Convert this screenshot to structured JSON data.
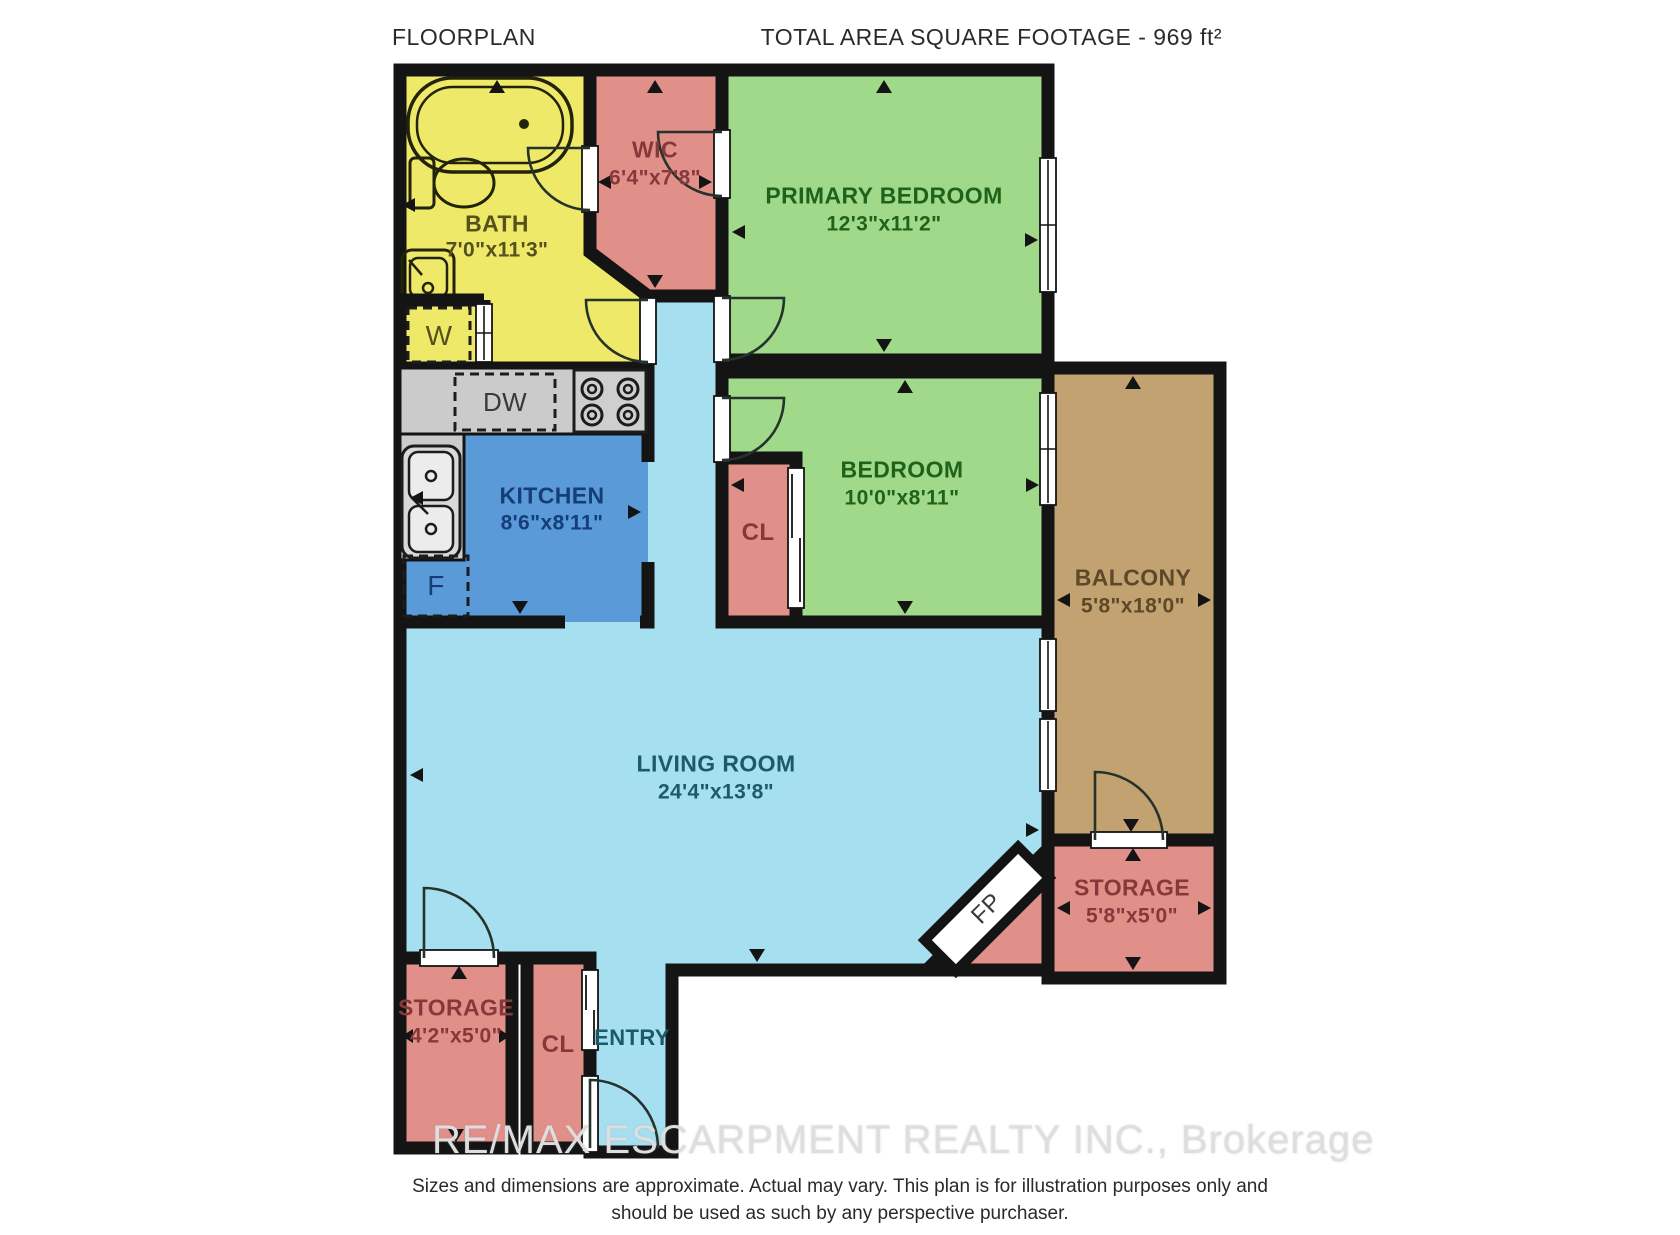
{
  "header": {
    "left": "FLOORPLAN",
    "right": "TOTAL AREA SQUARE FOOTAGE - 969 ft²"
  },
  "colors": {
    "bath": "#efe969",
    "closet": "#e18f89",
    "bedroom": "#a0d98a",
    "kitchen_floor": "#5a9ad8",
    "living": "#a6dff0",
    "balcony": "#c2a270",
    "counter": "#cbcbcb",
    "wall": "#141414"
  },
  "rooms": {
    "bath": {
      "name": "BATH",
      "dims": "7'0\"x11'3\""
    },
    "wic": {
      "name": "WIC",
      "dims": "6'4\"x7'8\""
    },
    "primary_bedroom": {
      "name": "PRIMARY BEDROOM",
      "dims": "12'3\"x11'2\""
    },
    "kitchen": {
      "name": "KITCHEN",
      "dims": "8'6\"x8'11\""
    },
    "bedroom": {
      "name": "BEDROOM",
      "dims": "10'0\"x8'11\""
    },
    "closet_hall": {
      "name": "CL"
    },
    "balcony": {
      "name": "BALCONY",
      "dims": "5'8\"x18'0\""
    },
    "living_room": {
      "name": "LIVING ROOM",
      "dims": "24'4\"x13'8\""
    },
    "storage_right": {
      "name": "STORAGE",
      "dims": "5'8\"x5'0\""
    },
    "storage_left": {
      "name": "STORAGE",
      "dims": "4'2\"x5'0\""
    },
    "closet_entry": {
      "name": "CL"
    },
    "entry": {
      "name": "ENTRY"
    }
  },
  "fixtures": {
    "washer": "W",
    "dishwasher": "DW",
    "fridge": "F",
    "fireplace": "FP"
  },
  "watermark": "RE/MAX ESCARPMENT REALTY INC., Brokerage",
  "disclaimer": {
    "line1": "Sizes and dimensions are approximate. Actual may vary. This plan is for illustration purposes only and",
    "line2": "should be used as such by any perspective purchaser."
  }
}
